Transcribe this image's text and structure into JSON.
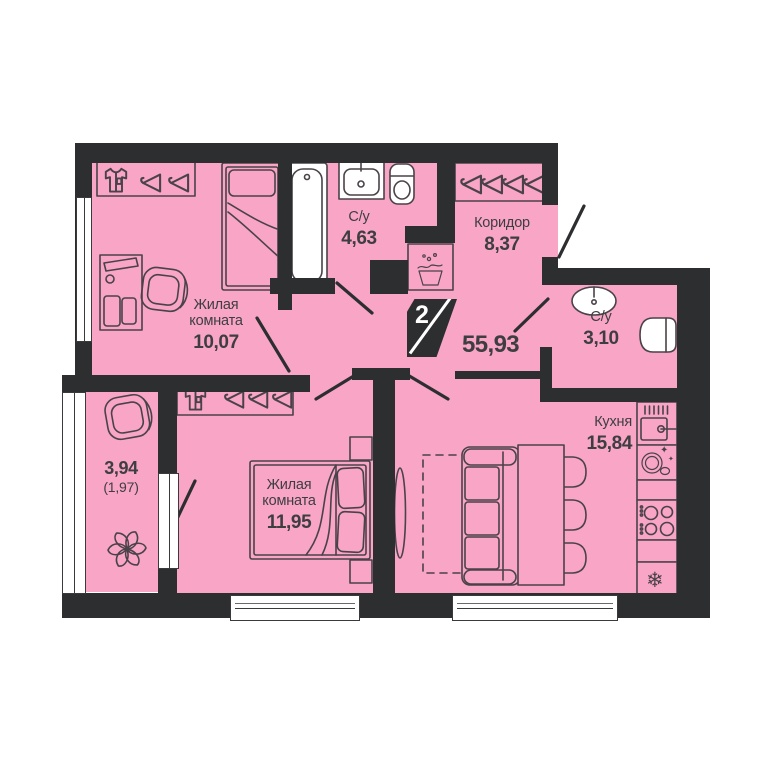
{
  "colors": {
    "room_fill": "#f8a5c6",
    "wall": "#2d2e30",
    "outline": "#4a4249",
    "text": "#3e3e40",
    "badge_text": "#ffffff"
  },
  "icons": {
    "snowflake": "❄",
    "sparkle_large": "✦",
    "sparkle_small": "✦"
  },
  "plan": {
    "badge_rooms": "2",
    "total_area": "55,93",
    "rooms": [
      {
        "name": "Жилая комната",
        "area": "10,07"
      },
      {
        "name": "С/у",
        "area": "4,63"
      },
      {
        "name": "Коридор",
        "area": "8,37"
      },
      {
        "name": "С/у",
        "area": "3,10"
      },
      {
        "name": "Кухня",
        "area": "15,84"
      },
      {
        "name": "Жилая комната",
        "area": "11,95"
      },
      {
        "area": "3,94",
        "area_secondary": "(1,97)"
      }
    ]
  }
}
